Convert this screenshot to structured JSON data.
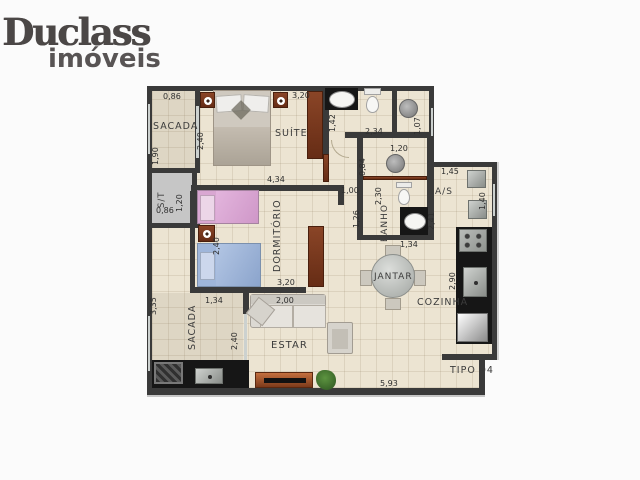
{
  "logo": {
    "brand": "Duclass",
    "tagline": "imóveis"
  },
  "floorplan": {
    "unit_label": "TIPO 04",
    "palette": {
      "walls": "#3a3a3a",
      "floor_tile": "#ece4d2",
      "wood_furniture": "#7b3b24",
      "counters": "#161616",
      "bed_pink": "#dba7d4",
      "bed_blue": "#9fb6da",
      "service_shaft": "#c6c6c6"
    },
    "rooms": [
      "SACADA",
      "SUÍTE",
      "S/T",
      "DORMITÓRIO",
      "BANHO",
      "A/S",
      "JANTAR",
      "COZINHA",
      "SACADA",
      "ESTAR"
    ],
    "labels": [
      {
        "t": "SACADA",
        "k": "room",
        "x": 6,
        "y": 36,
        "s": 9.5,
        "r": 0
      },
      {
        "t": "SUÍTE",
        "k": "room",
        "x": 128,
        "y": 43,
        "s": 9.5,
        "r": 0
      },
      {
        "t": "S/T",
        "k": "room",
        "x": 11,
        "y": 122,
        "s": 8.5,
        "r": -90
      },
      {
        "t": "DORMITÓRIO",
        "k": "room",
        "x": 126,
        "y": 186,
        "s": 9.5,
        "r": -90
      },
      {
        "t": "BANHO",
        "k": "room",
        "x": 234,
        "y": 156,
        "s": 9,
        "r": -90
      },
      {
        "t": "A/S",
        "k": "room",
        "x": 288,
        "y": 102,
        "s": 9,
        "r": 0
      },
      {
        "t": "JANTAR",
        "k": "room",
        "x": 227,
        "y": 187,
        "s": 9,
        "r": 0
      },
      {
        "t": "COZINHA",
        "k": "room",
        "x": 270,
        "y": 212,
        "s": 9.5,
        "r": 0
      },
      {
        "t": "SACADA",
        "k": "room",
        "x": 41,
        "y": 264,
        "s": 9.5,
        "r": -90
      },
      {
        "t": "ESTAR",
        "k": "room",
        "x": 124,
        "y": 255,
        "s": 10,
        "r": 0
      },
      {
        "t": "TIPO 04",
        "k": "unit",
        "x": 303,
        "y": 280,
        "s": 9.5,
        "r": 0
      },
      {
        "t": "0,86",
        "k": "dim",
        "x": 16,
        "y": 7,
        "s": 8,
        "r": 0
      },
      {
        "t": "3,20",
        "k": "dim",
        "x": 145,
        "y": 6,
        "s": 8,
        "r": 0
      },
      {
        "t": "1,90",
        "k": "dim",
        "x": 5,
        "y": 79,
        "s": 8,
        "r": -90
      },
      {
        "t": "2,40",
        "k": "dim",
        "x": 50,
        "y": 64,
        "s": 8,
        "r": -90
      },
      {
        "t": "4,34",
        "k": "dim",
        "x": 120,
        "y": 90,
        "s": 8,
        "r": 0
      },
      {
        "t": "1,42",
        "k": "dim",
        "x": 182,
        "y": 46,
        "s": 8,
        "r": -90
      },
      {
        "t": "2,34",
        "k": "dim",
        "x": 218,
        "y": 42,
        "s": 8,
        "r": 0
      },
      {
        "t": "1,07",
        "k": "dim",
        "x": 267,
        "y": 49,
        "s": 8,
        "r": -90
      },
      {
        "t": "0,84",
        "k": "dim",
        "x": 212,
        "y": 90,
        "s": 8,
        "r": -90
      },
      {
        "t": "1,20",
        "k": "dim",
        "x": 243,
        "y": 59,
        "s": 8,
        "r": 0
      },
      {
        "t": "1,20",
        "k": "dim",
        "x": 29,
        "y": 126,
        "s": 8,
        "r": -90
      },
      {
        "t": "0,86",
        "k": "dim",
        "x": 9,
        "y": 121,
        "s": 8,
        "r": 0
      },
      {
        "t": "1,00",
        "k": "dim",
        "x": 194,
        "y": 101,
        "s": 8,
        "r": 0
      },
      {
        "t": "2,30",
        "k": "dim",
        "x": 228,
        "y": 119,
        "s": 8,
        "r": -90
      },
      {
        "t": "1,26",
        "k": "dim",
        "x": 206,
        "y": 142,
        "s": 8,
        "r": -90
      },
      {
        "t": "2,41",
        "k": "dim",
        "x": 281,
        "y": 144,
        "s": 8,
        "r": -90
      },
      {
        "t": "1,45",
        "k": "dim",
        "x": 294,
        "y": 82,
        "s": 8,
        "r": 0
      },
      {
        "t": "1,40",
        "k": "dim",
        "x": 332,
        "y": 124,
        "s": 8,
        "r": -90
      },
      {
        "t": "2,40",
        "k": "dim",
        "x": 66,
        "y": 169,
        "s": 8,
        "r": -90
      },
      {
        "t": "1,34",
        "k": "dim",
        "x": 253,
        "y": 155,
        "s": 8,
        "r": 0
      },
      {
        "t": "3,20",
        "k": "dim",
        "x": 130,
        "y": 193,
        "s": 8,
        "r": 0
      },
      {
        "t": "2,00",
        "k": "dim",
        "x": 129,
        "y": 211,
        "s": 8,
        "r": 0
      },
      {
        "t": "1,34",
        "k": "dim",
        "x": 58,
        "y": 211,
        "s": 8,
        "r": 0
      },
      {
        "t": "3,35",
        "k": "dim",
        "x": 3,
        "y": 229,
        "s": 8,
        "r": -90
      },
      {
        "t": "2,40",
        "k": "dim",
        "x": 84,
        "y": 264,
        "s": 8,
        "r": -90
      },
      {
        "t": "2,90",
        "k": "dim",
        "x": 302,
        "y": 204,
        "s": 8,
        "r": -90
      },
      {
        "t": "5,93",
        "k": "dim",
        "x": 233,
        "y": 294,
        "s": 8,
        "r": 0
      }
    ]
  }
}
